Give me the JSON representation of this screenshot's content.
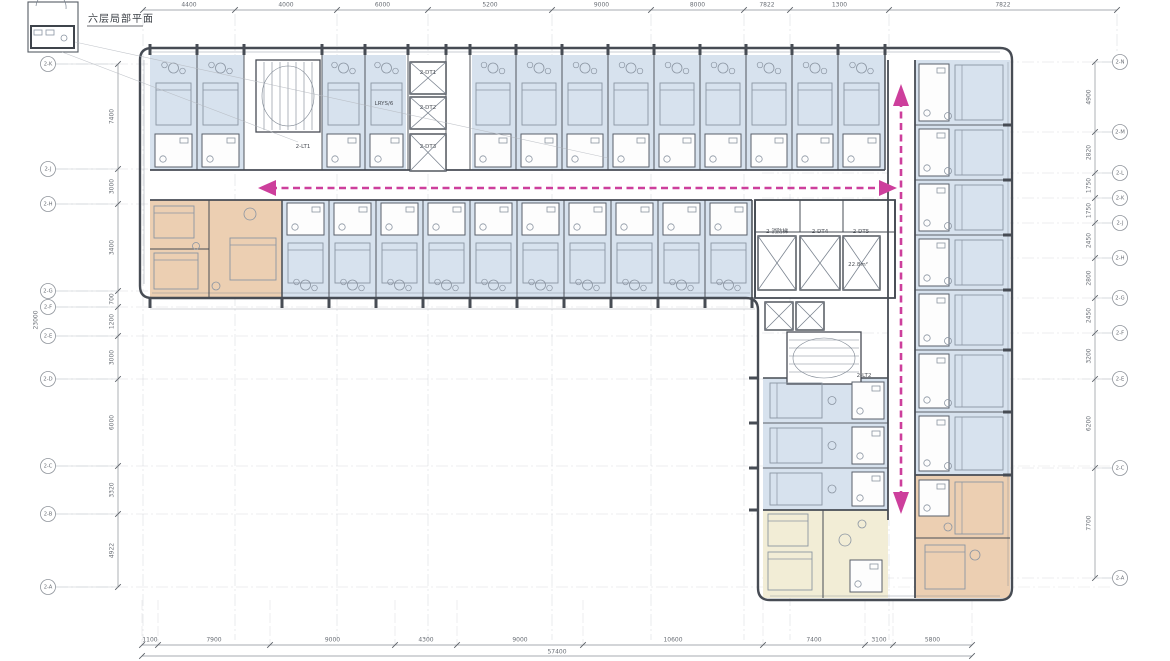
{
  "title": {
    "text": "六层局部平面"
  },
  "colors": {
    "wall": "#474c54",
    "thin": "#7b8490",
    "furniture": "#8b95a2",
    "room_blue": "#d7e2ee",
    "room_orange": "#eccfb2",
    "room_yellow": "#f2edd6",
    "grid": "#b4b8bf",
    "dim_text": "#686d74",
    "arrow_pink": "#cd3f9c",
    "white": "#ffffff"
  },
  "top_dims": {
    "labels": [
      "4400",
      "4000",
      "6000",
      "5200",
      "9000",
      "8000",
      "7822",
      "1300",
      "7822"
    ]
  },
  "bottom_dims": {
    "labels": [
      "1100",
      "7900",
      "9000",
      "4300",
      "9000",
      "10600",
      "7400",
      "3100",
      "5800"
    ],
    "total": "57400"
  },
  "left_dims": {
    "labels": [
      "7400",
      "3000",
      "3400",
      "700",
      "1200",
      "3000",
      "6000",
      "3320",
      "4922"
    ],
    "total": "23000"
  },
  "right_dims": {
    "labels": [
      "4900",
      "2820",
      "1750",
      "1750",
      "2450",
      "2800",
      "2450",
      "3200",
      "6200",
      "7700"
    ]
  },
  "left_bubbles": [
    {
      "label": "2-K"
    },
    {
      "label": "2-J"
    },
    {
      "label": "2-H"
    },
    {
      "label": "2-G"
    },
    {
      "label": "2-F"
    },
    {
      "label": "2-E"
    },
    {
      "label": "2-D"
    },
    {
      "label": "2-C"
    },
    {
      "label": "2-B"
    },
    {
      "label": "2-A"
    }
  ],
  "right_bubbles": [
    {
      "label": "2-N"
    },
    {
      "label": "2-M"
    },
    {
      "label": "2-L"
    },
    {
      "label": "2-K"
    },
    {
      "label": "2-J"
    },
    {
      "label": "2-H"
    },
    {
      "label": "2-G"
    },
    {
      "label": "2-F"
    },
    {
      "label": "2-E"
    },
    {
      "label": "2-C"
    },
    {
      "label": "2-A"
    }
  ],
  "plan_labels": [
    {
      "text": "2-LT1",
      "x": 303,
      "y": 147
    },
    {
      "text": "2-DT1",
      "x": 428,
      "y": 73
    },
    {
      "text": "2-DT2",
      "x": 428,
      "y": 108
    },
    {
      "text": "2-DT3",
      "x": 428,
      "y": 147
    },
    {
      "text": "LRYS/6",
      "x": 384,
      "y": 104
    },
    {
      "text": "2-消防梯",
      "x": 777,
      "y": 232
    },
    {
      "text": "2-DT4",
      "x": 820,
      "y": 232
    },
    {
      "text": "2-DT5",
      "x": 861,
      "y": 232
    },
    {
      "text": "22.8m²",
      "x": 858,
      "y": 265
    },
    {
      "text": "2-LT2",
      "x": 864,
      "y": 376
    },
    {
      "text": "2-LT1",
      "x": 66,
      "y": 17
    }
  ]
}
